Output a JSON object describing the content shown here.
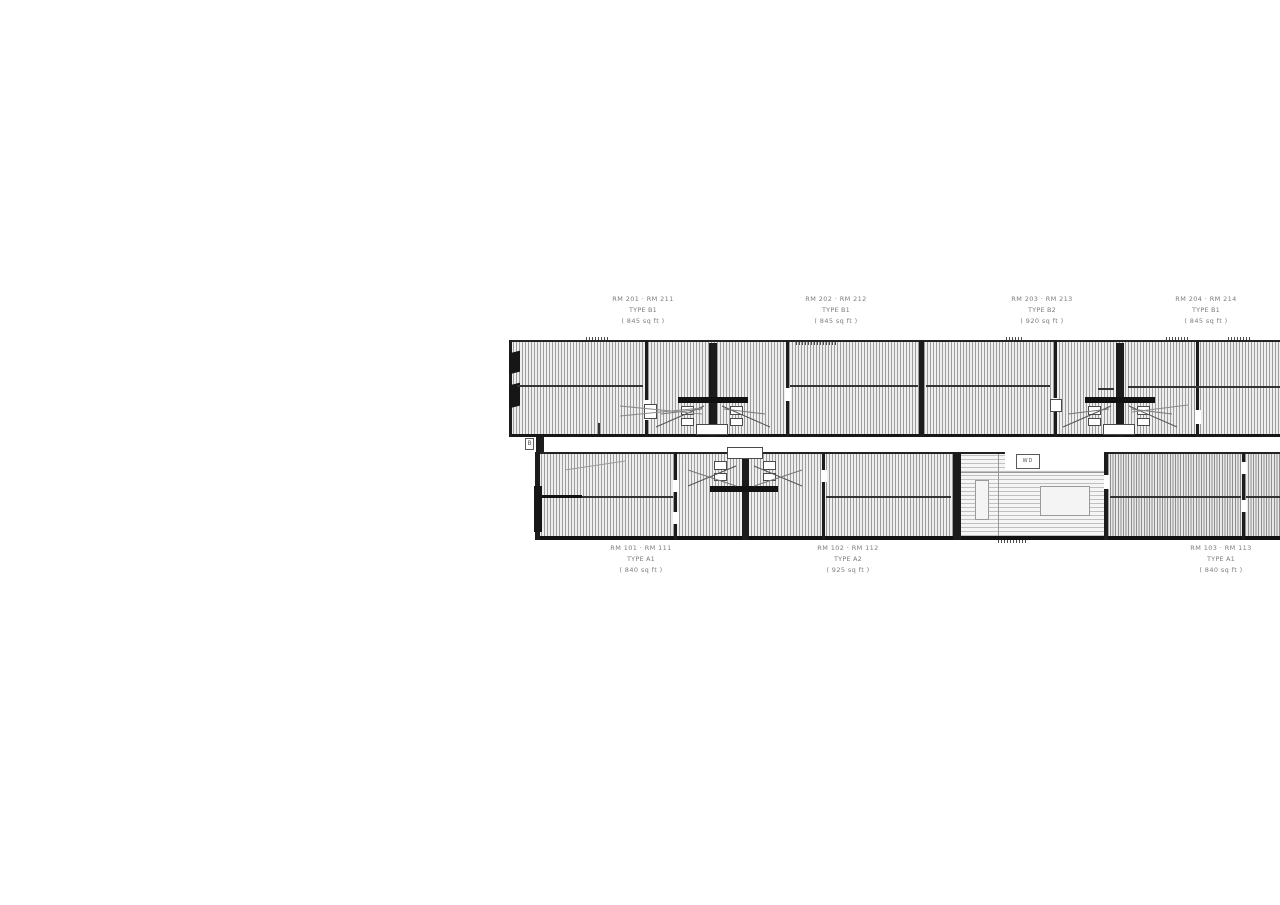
{
  "drawing": {
    "kind": "building floor plan (CAD)",
    "corridor_mark": "B",
    "equipment_box_glyph": "WD",
    "wall_color": "#1c1c1c",
    "hatch_line_color": "#9d9d9d",
    "label_color": "#7c7c7c"
  },
  "labels": {
    "top": [
      {
        "lines": [
          "RM 201 · RM 211",
          "TYPE B1",
          "( 845 sq ft )"
        ]
      },
      {
        "lines": [
          "RM 202 · RM 212",
          "TYPE B1",
          "( 845 sq ft )"
        ]
      },
      {
        "lines": [
          "RM 203 · RM 213",
          "TYPE B2",
          "( 920 sq ft )"
        ]
      },
      {
        "lines": [
          "RM 204 · RM 214",
          "TYPE B1",
          "( 845 sq ft )"
        ]
      }
    ],
    "bottom": [
      {
        "lines": [
          "RM 101 · RM 111",
          "TYPE A1",
          "( 840 sq ft )"
        ]
      },
      {
        "lines": [
          "RM 102 · RM 112",
          "TYPE A2",
          "( 925 sq ft )"
        ]
      },
      {
        "lines": [
          "RM 103 · RM 113",
          "TYPE A1",
          "( 840 sq ft )"
        ]
      }
    ]
  }
}
